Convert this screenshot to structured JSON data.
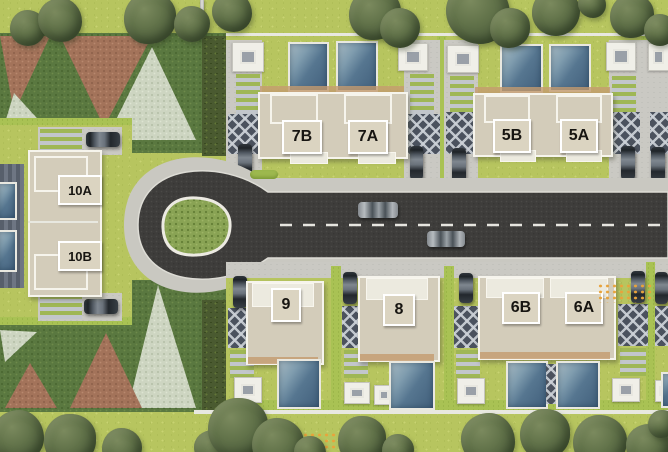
{
  "meta": {
    "title": "Residential compound master plan (top view)",
    "view": "aerial site plan"
  },
  "units": [
    {
      "id": "10A",
      "label": "10A"
    },
    {
      "id": "10B",
      "label": "10B"
    },
    {
      "id": "7B",
      "label": "7B"
    },
    {
      "id": "7A",
      "label": "7A"
    },
    {
      "id": "5B",
      "label": "5B"
    },
    {
      "id": "5A",
      "label": "5A"
    },
    {
      "id": "9",
      "label": "9"
    },
    {
      "id": "8",
      "label": "8"
    },
    {
      "id": "6B",
      "label": "6B"
    },
    {
      "id": "6A",
      "label": "6A"
    }
  ],
  "road": {
    "type": "cul-de-sac with straight avenue",
    "marking": "white dashed center line",
    "cars_on_road": 2
  },
  "colors": {
    "lawn": "#b7c55f",
    "asphalt": "#3e3d3b",
    "sidewalk": "#c9c8c1",
    "building": "#d3ccba",
    "pool": "#567690",
    "hedge_dark": "#4a5a30",
    "hedge_bright": "#a9c254",
    "gravel": "#cdd5c1",
    "soil": "#a3735a",
    "accent_dots": "#e8a33c"
  },
  "landscape": {
    "trees": [
      [
        28,
        28,
        18
      ],
      [
        60,
        20,
        22
      ],
      [
        150,
        18,
        26
      ],
      [
        192,
        24,
        18
      ],
      [
        232,
        12,
        20
      ],
      [
        375,
        14,
        26
      ],
      [
        400,
        28,
        20
      ],
      [
        478,
        12,
        32
      ],
      [
        510,
        28,
        20
      ],
      [
        556,
        12,
        24
      ],
      [
        592,
        4,
        14
      ],
      [
        632,
        16,
        22
      ],
      [
        660,
        30,
        16
      ],
      [
        18,
        436,
        26
      ],
      [
        70,
        440,
        26
      ],
      [
        122,
        448,
        20
      ],
      [
        212,
        448,
        18
      ],
      [
        238,
        428,
        30
      ],
      [
        278,
        444,
        26
      ],
      [
        310,
        452,
        16
      ],
      [
        362,
        440,
        24
      ],
      [
        398,
        450,
        16
      ],
      [
        488,
        440,
        27
      ],
      [
        545,
        434,
        25
      ],
      [
        600,
        442,
        27
      ],
      [
        648,
        446,
        22
      ],
      [
        662,
        424,
        14
      ]
    ],
    "dot_grids": [
      [
        597,
        283,
        56,
        20
      ],
      [
        295,
        432,
        58,
        18
      ]
    ]
  }
}
